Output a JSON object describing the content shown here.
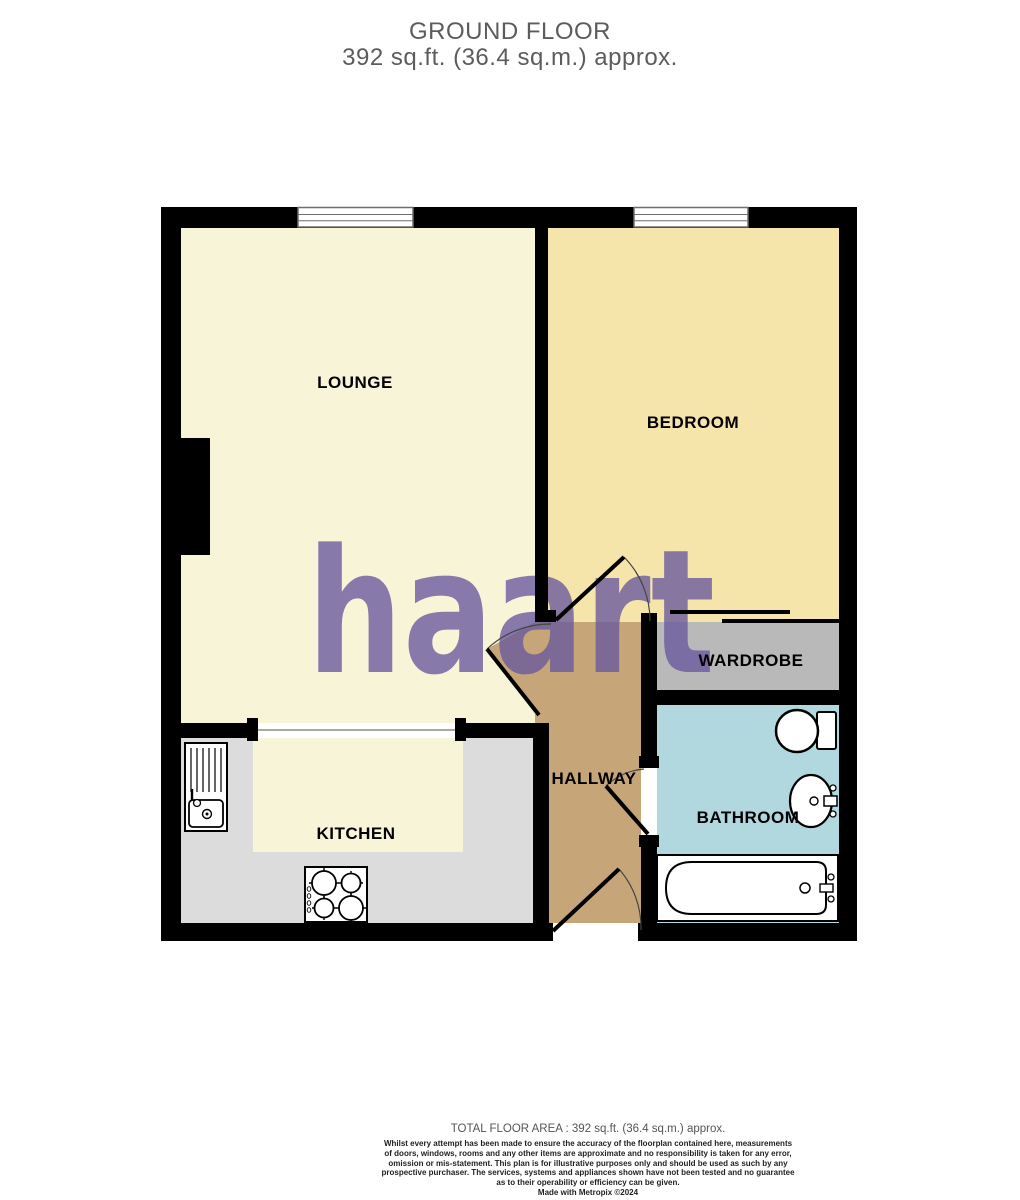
{
  "title": {
    "line1": "GROUND FLOOR",
    "line2": "392 sq.ft. (36.4 sq.m.) approx."
  },
  "watermark": {
    "text": "haart",
    "color": "#6a5a9e"
  },
  "rooms": {
    "lounge": {
      "label": "LOUNGE",
      "color": "#f8f4d8"
    },
    "bedroom": {
      "label": "BEDROOM",
      "color": "#f6e5aa"
    },
    "kitchen": {
      "label": "KITCHEN",
      "floor_color": "#f8f4d8",
      "counter_color": "#dcdcdc"
    },
    "hallway": {
      "label": "HALLWAY",
      "color": "#c6a679"
    },
    "wardrobe": {
      "label": "WARDROBE",
      "color": "#b9b9b9"
    },
    "bathroom": {
      "label": "BATHROOM",
      "color": "#b1d8de"
    }
  },
  "footer": {
    "total_area": "TOTAL FLOOR AREA : 392 sq.ft. (36.4 sq.m.) approx.",
    "disclaimer_lines": [
      "Whilst every attempt has been made to ensure the accuracy of the floorplan contained here, measurements",
      "of doors, windows, rooms and any other items are approximate and no responsibility is taken for any error,",
      "omission or mis-statement. This plan is for illustrative purposes only and should be used as such by any",
      "prospective purchaser. The services, systems and appliances shown have not been tested and no guarantee",
      "as to their operability or efficiency can be given."
    ],
    "credit": "Made with Metropix ©2024"
  }
}
